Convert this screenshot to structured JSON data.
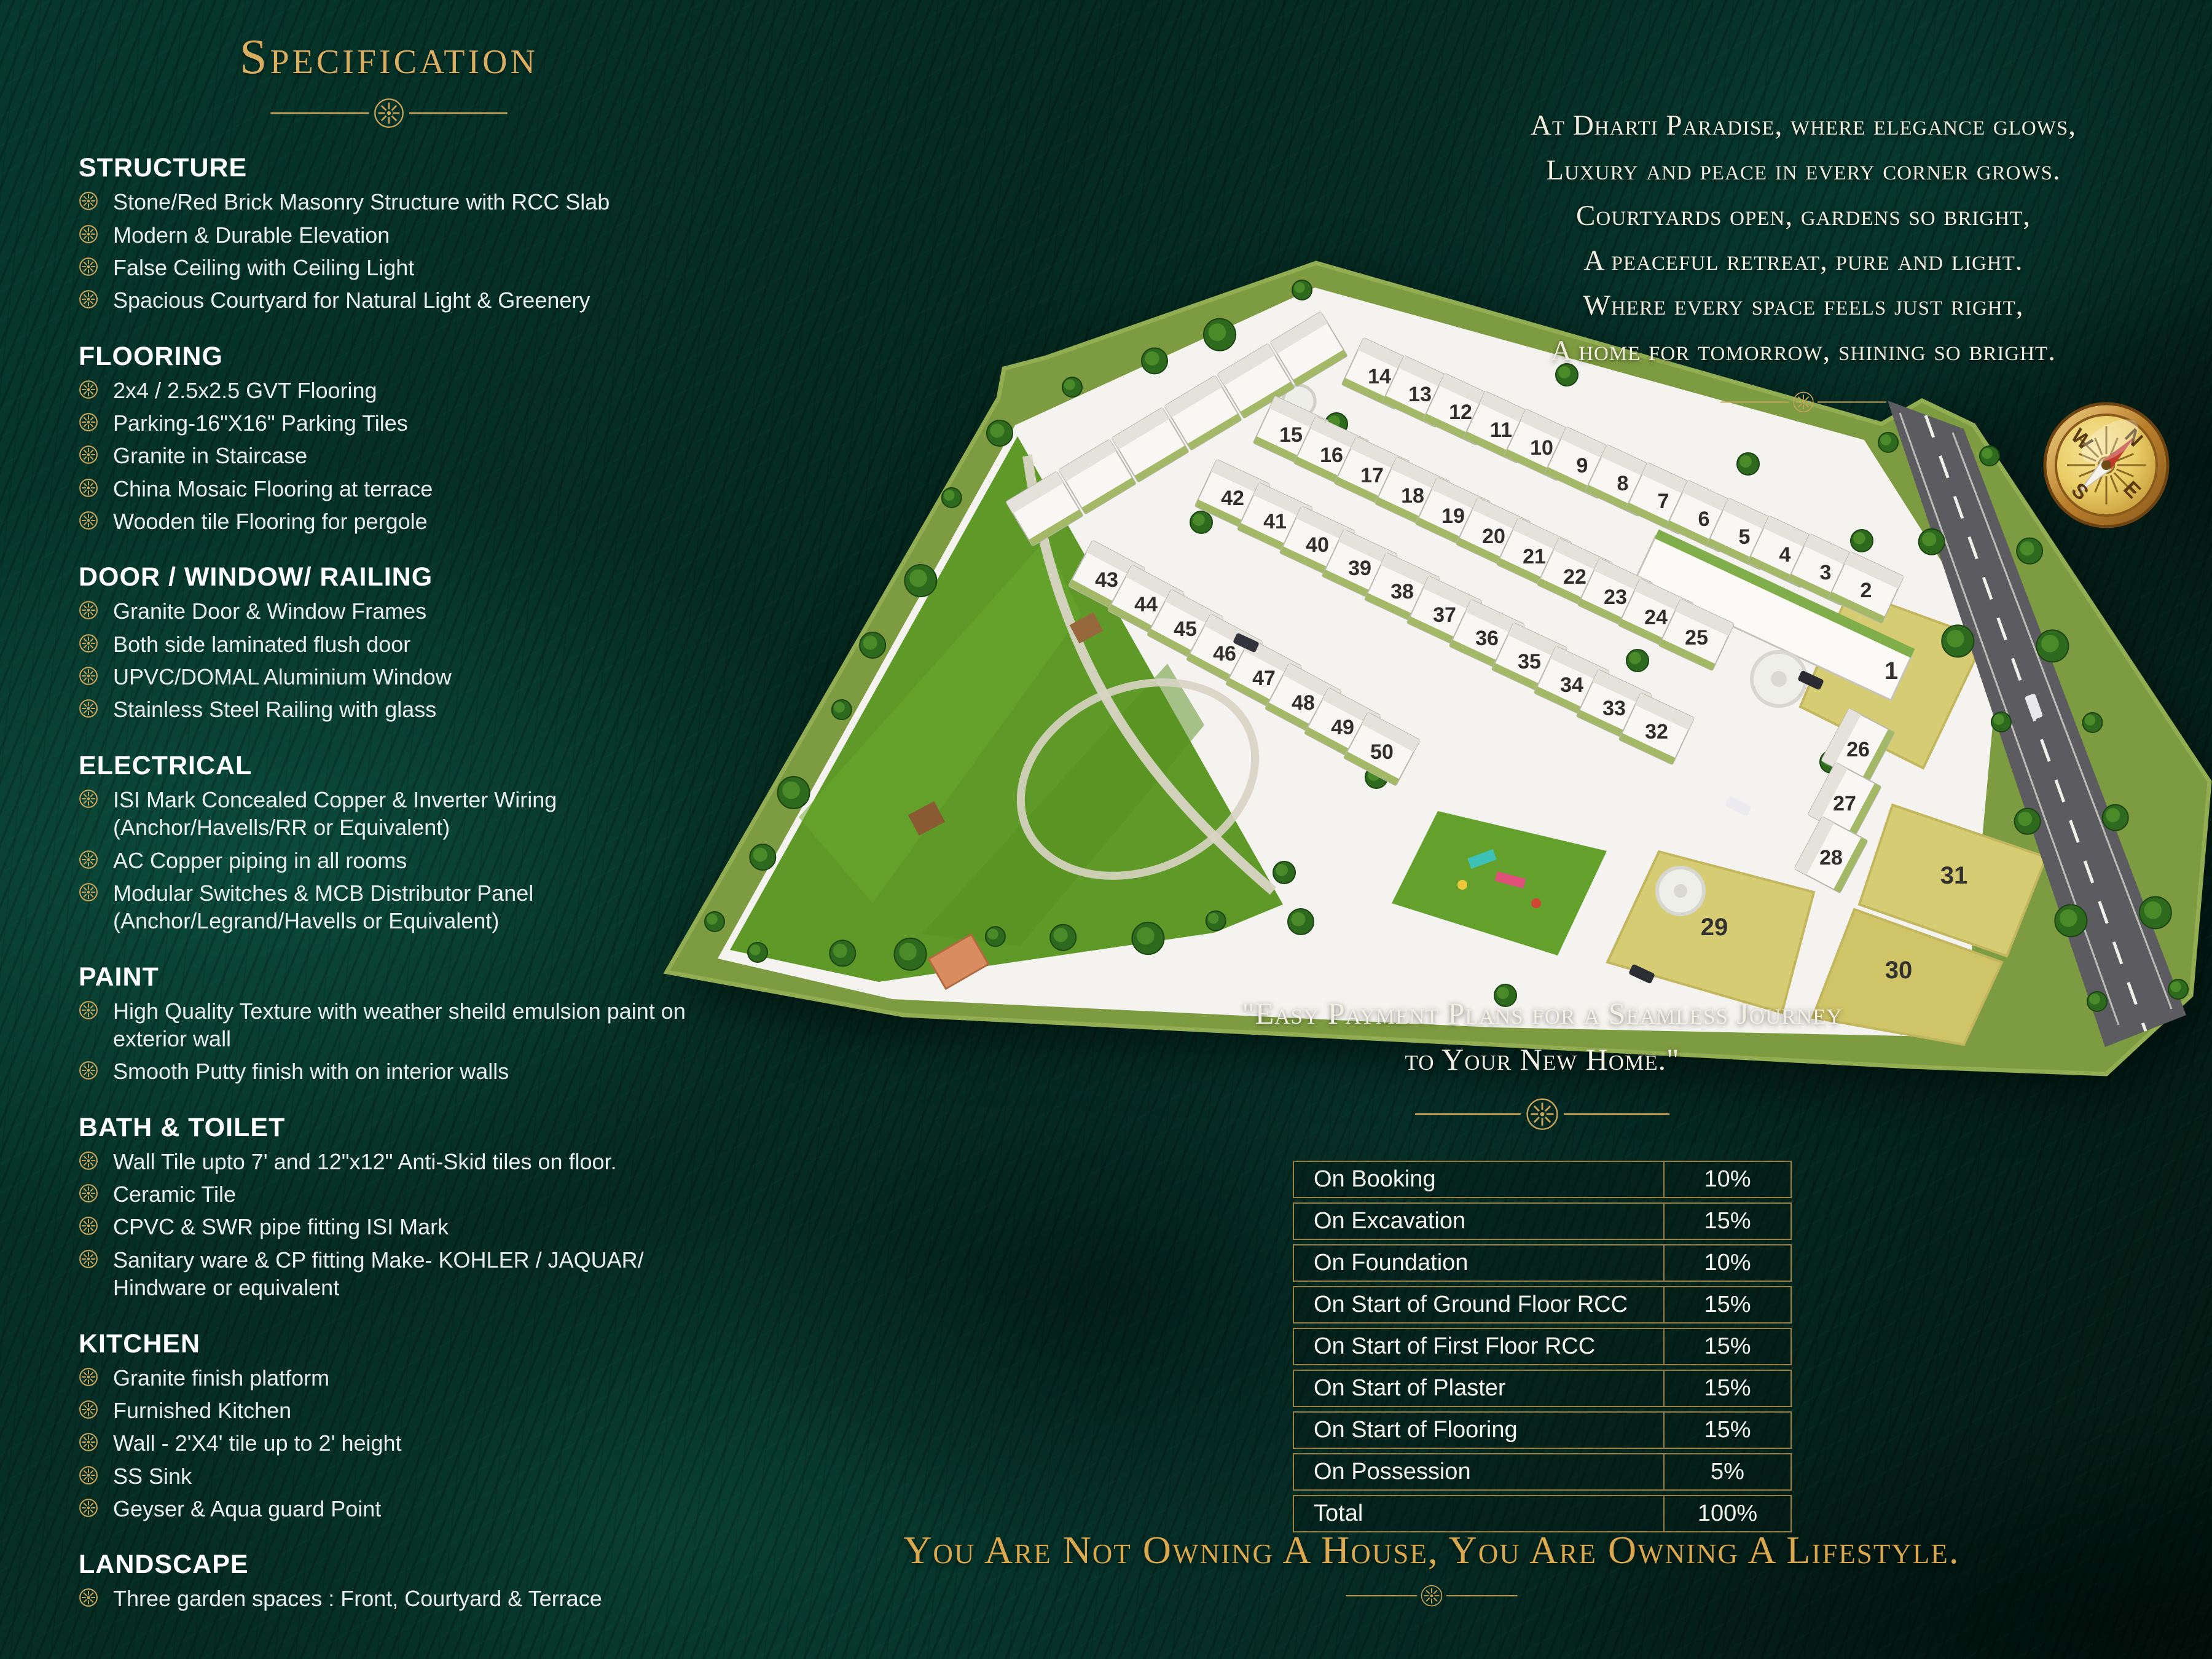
{
  "colors": {
    "background_teal": "#07332a",
    "emerald_highlight": "#0d5a47",
    "gold": "#c8a45c",
    "title_gold": "#d7ae62",
    "text_white": "#e8eeec",
    "site_border_green": "#7d9b41",
    "lawn_green": "#5f9a28",
    "plat_white": "#f4f3ef",
    "open_plot_yellow": "#d6cc74",
    "road_gray": "#5c5c60",
    "table_border_gold": "#997f41"
  },
  "spec": {
    "title": "Specification",
    "sections": [
      {
        "heading": "STRUCTURE",
        "items": [
          "Stone/Red Brick Masonry Structure with RCC Slab",
          "Modern & Durable Elevation",
          "False Ceiling with Ceiling Light",
          "Spacious Courtyard for Natural Light & Greenery"
        ]
      },
      {
        "heading": "FLOORING",
        "items": [
          "2x4 / 2.5x2.5 GVT Flooring",
          "Parking-16\"X16\" Parking Tiles",
          "Granite in Staircase",
          "China Mosaic Flooring at terrace",
          "Wooden tile Flooring for pergole"
        ]
      },
      {
        "heading": "DOOR / WINDOW/ RAILING",
        "items": [
          "Granite Door & Window Frames",
          "Both side laminated flush door",
          "UPVC/DOMAL Aluminium Window",
          "Stainless Steel Railing with glass"
        ]
      },
      {
        "heading": "ELECTRICAL",
        "items": [
          "ISI Mark Concealed Copper & Inverter Wiring (Anchor/Havells/RR or Equivalent)",
          "AC Copper piping in all rooms",
          "Modular Switches & MCB Distributor Panel (Anchor/Legrand/Havells or Equivalent)"
        ]
      },
      {
        "heading": "PAINT",
        "items": [
          "High Quality Texture with weather sheild emulsion paint on exterior wall",
          "Smooth Putty finish with on interior walls"
        ]
      },
      {
        "heading": "BATH & TOILET",
        "items": [
          "Wall Tile upto 7' and 12\"x12\" Anti-Skid tiles on floor.",
          "Ceramic Tile",
          "CPVC & SWR pipe fitting ISI Mark",
          "Sanitary ware & CP fitting Make- KOHLER / JAQUAR/ Hindware or equivalent"
        ]
      },
      {
        "heading": "KITCHEN",
        "items": [
          "Granite finish platform",
          "Furnished Kitchen",
          "Wall - 2'X4' tile up to 2' height",
          "SS Sink",
          "Geyser & Aqua guard Point"
        ]
      },
      {
        "heading": "LANDSCAPE",
        "items": [
          "Three garden spaces : Front, Courtyard & Terrace"
        ]
      }
    ]
  },
  "poem": {
    "lines": [
      "At Dharti Paradise, where elegance glows,",
      "Luxury and peace in every corner grows.",
      "Courtyards open, gardens so bright,",
      "A peaceful retreat, pure and light.",
      "Where every space feels just right,",
      "A home for tomorrow, shining so bright."
    ]
  },
  "site_plan": {
    "compass": {
      "north": "N",
      "east": "E",
      "south": "S",
      "west": "W"
    },
    "rows": {
      "north_row": [
        "14",
        "13",
        "12",
        "11",
        "10",
        "9",
        "8",
        "7",
        "6",
        "5",
        "4",
        "3",
        "2"
      ],
      "second_row": [
        "15",
        "16",
        "17",
        "18",
        "19",
        "20",
        "21",
        "22",
        "23",
        "24",
        "25"
      ],
      "third_row": [
        "42",
        "41",
        "40",
        "39",
        "38",
        "37",
        "36",
        "35",
        "34",
        "33",
        "32"
      ],
      "south_row": [
        "43",
        "44",
        "45",
        "46",
        "47",
        "48",
        "49",
        "50"
      ],
      "east_column": [
        "26",
        "27",
        "28"
      ]
    },
    "open_plots": [
      "1",
      "29",
      "30",
      "31"
    ]
  },
  "payment": {
    "heading_lines": [
      "\"Easy Payment Plans for a Seamless Journey",
      "to Your New Home.\""
    ],
    "rows": [
      {
        "label": "On Booking",
        "value": "10%"
      },
      {
        "label": "On Excavation",
        "value": "15%"
      },
      {
        "label": "On Foundation",
        "value": "10%"
      },
      {
        "label": "On Start of Ground Floor RCC",
        "value": "15%"
      },
      {
        "label": "On Start of First Floor RCC",
        "value": "15%"
      },
      {
        "label": "On Start of Plaster",
        "value": "15%"
      },
      {
        "label": "On Start of Flooring",
        "value": "15%"
      },
      {
        "label": "On Possession",
        "value": "5%"
      },
      {
        "label": "Total",
        "value": "100%"
      }
    ]
  },
  "tagline": {
    "text": "You Are Not Owning A House, You Are Owning A Lifestyle."
  }
}
